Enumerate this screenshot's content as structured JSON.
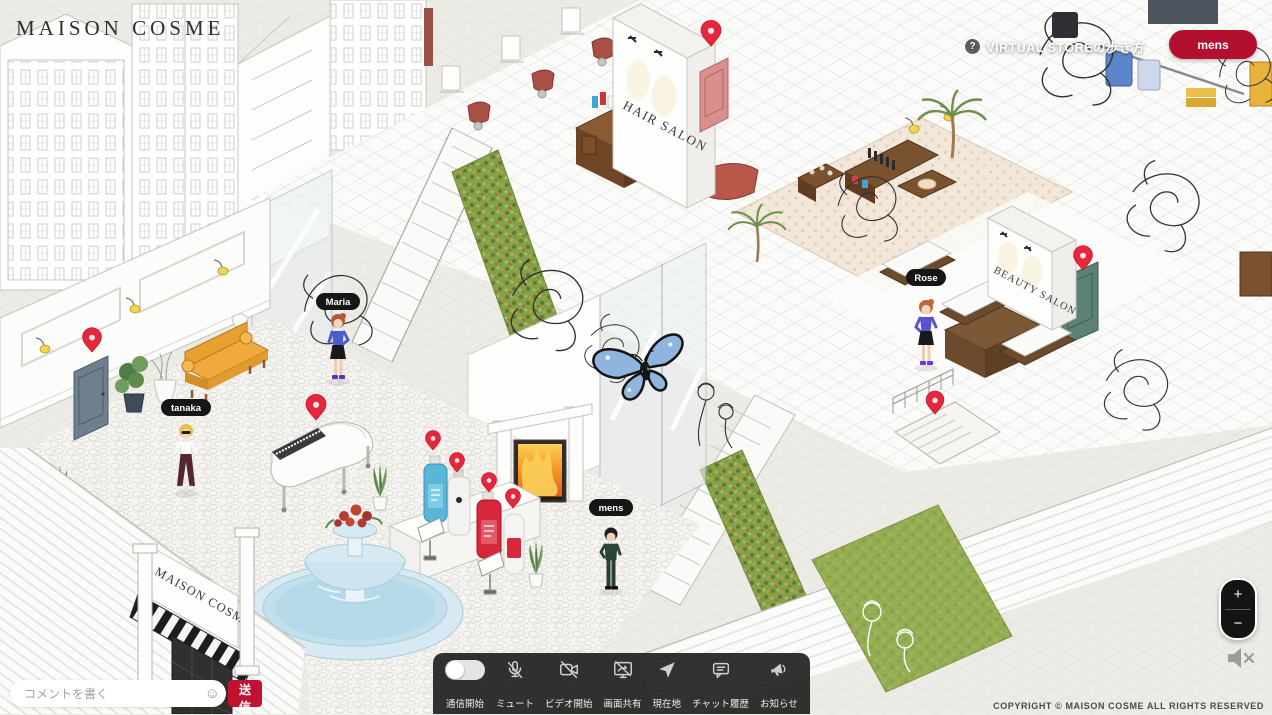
{
  "brand": {
    "logo": "MAISON COSME"
  },
  "header": {
    "help_icon": "?",
    "help_label": "VIRTUAL STOREの歩き方",
    "mens_button": "mens"
  },
  "chat": {
    "placeholder": "コメントを書く",
    "emoji_icon": "☺",
    "send": "送信"
  },
  "toolbar": {
    "items": [
      {
        "icon": "voice-toggle",
        "label": "通信開始"
      },
      {
        "icon": "mic-muted",
        "label": "ミュート"
      },
      {
        "icon": "video-off",
        "label": "ビデオ開始"
      },
      {
        "icon": "screen-share-off",
        "label": "画面共有"
      },
      {
        "icon": "location-arrow",
        "label": "現在地"
      },
      {
        "icon": "chat-bubble",
        "label": "チャット履歴"
      },
      {
        "icon": "megaphone",
        "label": "お知らせ"
      }
    ]
  },
  "zoom": {
    "in": "+",
    "out": "−"
  },
  "audio": {
    "muted_icon": "speaker-muted"
  },
  "footer": {
    "copyright": "COPYRIGHT © MAISON COSME ALL RIGHTS RESERVED"
  },
  "scene": {
    "signs": {
      "hair_salon": "HAIR SALON",
      "beauty_salon": "BEAUTY SALON",
      "storefront_sign": "MAISON COSME"
    },
    "avatars": [
      {
        "name": "Maria"
      },
      {
        "name": "tanaka"
      },
      {
        "name": "Rose"
      },
      {
        "name": "mens"
      }
    ],
    "colors": {
      "accent_red": "#b30f2e",
      "pin_red": "#e6273b",
      "hedge_green": "#86a04a",
      "fountain_blue": "#d7e9f2",
      "butterfly_blue": "#8fb4dd",
      "wood_brown": "#7a5230",
      "sofa_yellow": "#f0a93c",
      "salon_chair_red": "#a85045"
    }
  }
}
